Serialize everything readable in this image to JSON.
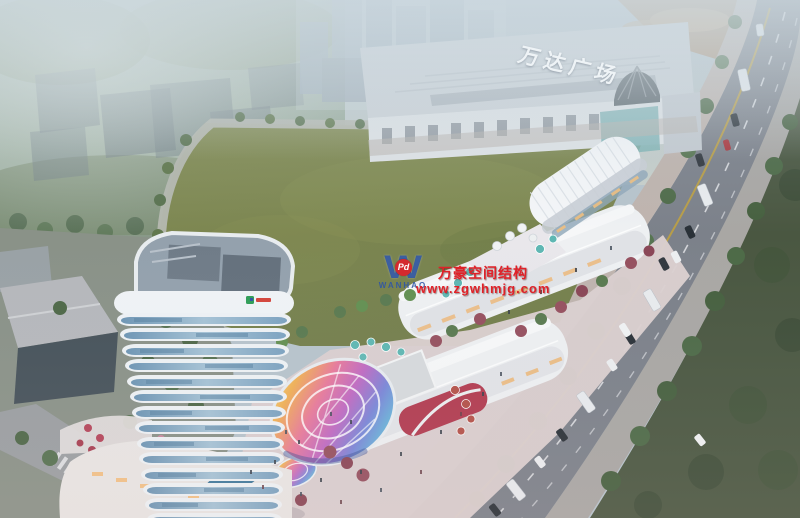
{
  "building_sign": {
    "text": "万达广场",
    "color": "#eef3f6"
  },
  "watermark": {
    "logo_letter": "W",
    "logo_badge": "Pd",
    "logo_name": "WANHAO",
    "line1": "万豪空间结构",
    "line2": "www.zgwhmjg.com",
    "red": "#e02128",
    "blue": "#2f55a5"
  },
  "palette": {
    "sky_haze": "#b7c4cc",
    "field_green": "#7d8751",
    "road_gray": "#7c818a",
    "lawn_dark": "#4a5741",
    "tower_facade": "#eef2f5",
    "tower_glass": "#7ba2c0",
    "mall_white": "#eef0f2",
    "mall_red_accent": "#b23b50",
    "umbrella_teal": "#5fb7b3",
    "construction_tan": "#b2997f",
    "dome_rainbow": [
      "#f2e48a",
      "#f0b055",
      "#e87a9a",
      "#c06ac2",
      "#7a86d8",
      "#62c6da"
    ]
  }
}
